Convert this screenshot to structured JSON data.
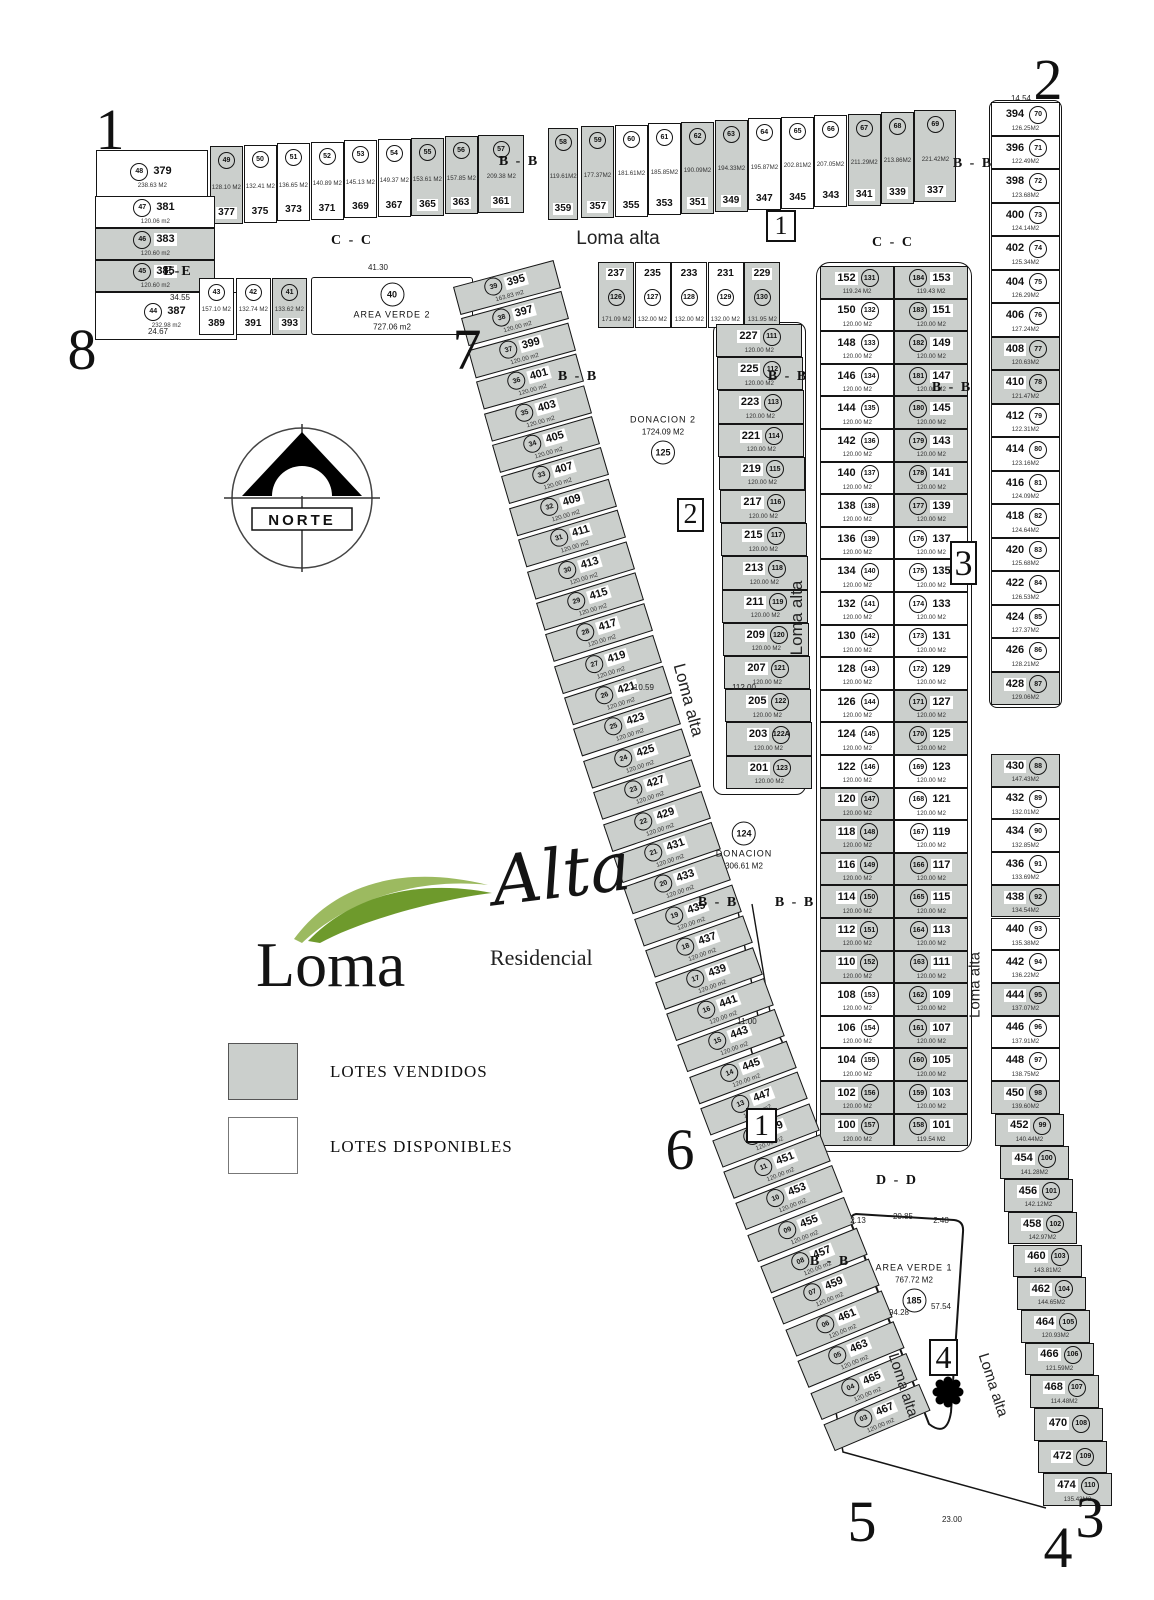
{
  "title": "Loma Alta Residencial - plano de lotificacion",
  "logo": {
    "loma": "Loma",
    "alta": "Alta",
    "residencial": "Residencial"
  },
  "legend": {
    "sold_label": "LOTES VENDIDOS",
    "available_label": "LOTES DISPONIBLES",
    "sold_color": "#cbcfcc",
    "available_color": "#ffffff"
  },
  "north": {
    "label": "NORTE"
  },
  "colors": {
    "line": "#151515",
    "sold_fill": "#cbcfcc",
    "logo_green_dark": "#6e9a2c",
    "logo_green_light": "#9cba60"
  },
  "areas": [
    {
      "name": "AREA VERDE 2",
      "area": "727.06 m2",
      "circle": "40",
      "x": 392,
      "y": 307,
      "seq": [
        "circle",
        "name",
        "area"
      ],
      "box": [
        311,
        277,
        162,
        58
      ]
    },
    {
      "name": "DONACION 2",
      "area": "1724.09 M2",
      "circle": "125",
      "x": 663,
      "y": 440,
      "seq": [
        "name",
        "area",
        "circle"
      ]
    },
    {
      "name": "DONACION",
      "area": "306.61 M2",
      "circle": "124",
      "x": 744,
      "y": 846,
      "seq": [
        "circle",
        "name",
        "area"
      ]
    },
    {
      "name": "AREA VERDE 1",
      "area": "767.72 M2",
      "circle": "185",
      "x": 914,
      "y": 1288,
      "seq": [
        "name",
        "area",
        "circle"
      ]
    }
  ],
  "street_labels": [
    {
      "t": "Loma alta",
      "x": 618,
      "y": 239,
      "r": 0,
      "fs": 19
    },
    {
      "t": "Loma alta",
      "x": 797,
      "y": 618,
      "r": -90,
      "fs": 17
    },
    {
      "t": "Loma alta",
      "x": 975,
      "y": 985,
      "r": -90,
      "fs": 15
    },
    {
      "t": "Loma alta",
      "x": 688,
      "y": 700,
      "r": 75,
      "fs": 17
    },
    {
      "t": "Loma alta",
      "x": 903,
      "y": 1385,
      "r": 72,
      "fs": 15
    },
    {
      "t": "Loma alta",
      "x": 993,
      "y": 1385,
      "r": 72,
      "fs": 15
    }
  ],
  "section_labels": [
    {
      "t": "C - C",
      "x": 352,
      "y": 241
    },
    {
      "t": "C - C",
      "x": 893,
      "y": 243
    },
    {
      "t": "B - B",
      "x": 519,
      "y": 162
    },
    {
      "t": "B - B",
      "x": 973,
      "y": 164
    },
    {
      "t": "B - B",
      "x": 578,
      "y": 377
    },
    {
      "t": "B - B",
      "x": 788,
      "y": 377
    },
    {
      "t": "B - B",
      "x": 952,
      "y": 388
    },
    {
      "t": "B - B",
      "x": 718,
      "y": 903
    },
    {
      "t": "B - B",
      "x": 795,
      "y": 903
    },
    {
      "t": "B - B",
      "x": 830,
      "y": 1262
    },
    {
      "t": "D - D",
      "x": 897,
      "y": 1181
    },
    {
      "t": "E-E",
      "x": 178,
      "y": 272
    }
  ],
  "corner_numbers": [
    {
      "t": "1",
      "x": 110,
      "y": 130
    },
    {
      "t": "2",
      "x": 1048,
      "y": 80
    },
    {
      "t": "8",
      "x": 82,
      "y": 350
    },
    {
      "t": "7",
      "x": 467,
      "y": 350
    },
    {
      "t": "6",
      "x": 680,
      "y": 1150
    },
    {
      "t": "5",
      "x": 862,
      "y": 1522
    },
    {
      "t": "3",
      "x": 1090,
      "y": 1518
    },
    {
      "t": "4",
      "x": 1058,
      "y": 1548
    }
  ],
  "boxed_numbers": [
    {
      "t": "1",
      "x": 766,
      "y": 210,
      "w": 30,
      "h": 32,
      "fs": 26
    },
    {
      "t": "2",
      "x": 677,
      "y": 498,
      "w": 27,
      "h": 34,
      "fs": 28
    },
    {
      "t": "3",
      "x": 950,
      "y": 541,
      "w": 27,
      "h": 44,
      "fs": 36
    },
    {
      "t": "1",
      "x": 746,
      "y": 1108,
      "w": 31,
      "h": 35,
      "fs": 30
    },
    {
      "t": "4",
      "x": 929,
      "y": 1339,
      "w": 29,
      "h": 37,
      "fs": 32
    }
  ],
  "dimensions": [
    {
      "t": "41.30",
      "x": 378,
      "y": 268
    },
    {
      "t": "110.59",
      "x": 642,
      "y": 688
    },
    {
      "t": "112.00",
      "x": 744,
      "y": 688
    },
    {
      "t": "11.00",
      "x": 747,
      "y": 1022
    },
    {
      "t": "23.00",
      "x": 952,
      "y": 1520
    },
    {
      "t": "2.13",
      "x": 858,
      "y": 1221
    },
    {
      "t": "20.85",
      "x": 903,
      "y": 1217
    },
    {
      "t": "2.48",
      "x": 941,
      "y": 1221
    },
    {
      "t": "57.54",
      "x": 941,
      "y": 1307
    },
    {
      "t": "94.28",
      "x": 899,
      "y": 1313
    },
    {
      "t": "14.54",
      "x": 1021,
      "y": 99
    },
    {
      "t": "24.67",
      "x": 158,
      "y": 332
    },
    {
      "t": "34.55",
      "x": 180,
      "y": 298
    }
  ],
  "lots": {
    "lot_379": [
      "379",
      "48",
      "238.63 M2",
      0
    ],
    "strip_a": [
      [
        "377",
        "49",
        "128.10 M2",
        1
      ],
      [
        "375",
        "50",
        "132.41 M2",
        0
      ],
      [
        "373",
        "51",
        "136.65 M2",
        0
      ],
      [
        "371",
        "52",
        "140.89 M2",
        0
      ],
      [
        "369",
        "53",
        "145.13 M2",
        0
      ],
      [
        "367",
        "54",
        "149.37 M2",
        0
      ],
      [
        "365",
        "55",
        "153.61 M2",
        1
      ],
      [
        "363",
        "56",
        "157.85 M2",
        1
      ],
      [
        "361",
        "57",
        "209.38 M2",
        1
      ]
    ],
    "col_b": [
      [
        "381",
        "47",
        "120.06 m2",
        0
      ],
      [
        "383",
        "46",
        "120.60 m2",
        1
      ],
      [
        "385",
        "45",
        "120.60 m2",
        1
      ],
      [
        "387",
        "44",
        "232.98 m2",
        0
      ]
    ],
    "row_c": [
      [
        "389",
        "43",
        "157.10 M2",
        0
      ],
      [
        "391",
        "42",
        "132.74 M2",
        0
      ],
      [
        "393",
        "41",
        "133.62 M2",
        1
      ]
    ],
    "strip_d": [
      [
        "359",
        "58",
        "119.61M2",
        1
      ],
      [
        "357",
        "59",
        "177.37M2",
        1
      ],
      [
        "355",
        "60",
        "181.61M2",
        0
      ],
      [
        "353",
        "61",
        "185.85M2",
        0
      ],
      [
        "351",
        "62",
        "190.09M2",
        1
      ],
      [
        "349",
        "63",
        "194.33M2",
        1
      ],
      [
        "347",
        "64",
        "195.87M2",
        0
      ],
      [
        "345",
        "65",
        "202.81M2",
        0
      ],
      [
        "343",
        "66",
        "207.05M2",
        0
      ],
      [
        "341",
        "67",
        "211.29M2",
        1
      ],
      [
        "339",
        "68",
        "213.86M2",
        1
      ],
      [
        "337",
        "69",
        "221.42M2",
        1
      ]
    ],
    "row_e": [
      [
        "237",
        "126",
        "171.09 M2",
        1
      ],
      [
        "235",
        "127",
        "132.00 M2",
        0
      ],
      [
        "233",
        "128",
        "132.00 M2",
        0
      ],
      [
        "231",
        "129",
        "132.00 M2",
        0
      ],
      [
        "229",
        "130",
        "131.95 M2",
        1
      ]
    ],
    "col_f": [
      [
        "227",
        "111",
        "120.00 M2",
        1
      ],
      [
        "225",
        "112",
        "120.00 M2",
        1
      ],
      [
        "223",
        "113",
        "120.00 M2",
        1
      ],
      [
        "221",
        "114",
        "120.00 M2",
        1
      ],
      [
        "219",
        "115",
        "120.00 M2",
        1
      ],
      [
        "217",
        "116",
        "120.00 M2",
        1
      ],
      [
        "215",
        "117",
        "120.00 M2",
        1
      ],
      [
        "213",
        "118",
        "120.00 M2",
        1
      ],
      [
        "211",
        "119",
        "120.00 M2",
        1
      ],
      [
        "209",
        "120",
        "120.00 M2",
        1
      ],
      [
        "207",
        "121",
        "120.00 M2",
        1
      ],
      [
        "205",
        "122",
        "120.00 M2",
        1
      ],
      [
        "203",
        "122A",
        "120.00 M2",
        1
      ],
      [
        "201",
        "123",
        "120.00 M2",
        1
      ]
    ],
    "col_g": [
      [
        "152",
        "131",
        "119.24 M2",
        1
      ],
      [
        "150",
        "132",
        "120.00 M2",
        0
      ],
      [
        "148",
        "133",
        "120.00 M2",
        0
      ],
      [
        "146",
        "134",
        "120.00 M2",
        0
      ],
      [
        "144",
        "135",
        "120.00 M2",
        0
      ],
      [
        "142",
        "136",
        "120.00 M2",
        0
      ],
      [
        "140",
        "137",
        "120.00 M2",
        0
      ],
      [
        "138",
        "138",
        "120.00 M2",
        0
      ],
      [
        "136",
        "139",
        "120.00 M2",
        0
      ],
      [
        "134",
        "140",
        "120.00 M2",
        0
      ],
      [
        "132",
        "141",
        "120.00 M2",
        0
      ],
      [
        "130",
        "142",
        "120.00 M2",
        0
      ],
      [
        "128",
        "143",
        "120.00 M2",
        0
      ],
      [
        "126",
        "144",
        "120.00 M2",
        0
      ],
      [
        "124",
        "145",
        "120.00 M2",
        0
      ],
      [
        "122",
        "146",
        "120.00 M2",
        0
      ],
      [
        "120",
        "147",
        "120.00 M2",
        1
      ],
      [
        "118",
        "148",
        "120.00 M2",
        1
      ],
      [
        "116",
        "149",
        "120.00 M2",
        1
      ],
      [
        "114",
        "150",
        "120.00 M2",
        1
      ],
      [
        "112",
        "151",
        "120.00 M2",
        1
      ],
      [
        "110",
        "152",
        "120.00 M2",
        1
      ],
      [
        "108",
        "153",
        "120.00 M2",
        0
      ],
      [
        "106",
        "154",
        "120.00 M2",
        0
      ],
      [
        "104",
        "155",
        "120.00 M2",
        0
      ],
      [
        "102",
        "156",
        "120.00 M2",
        1
      ],
      [
        "100",
        "157",
        "120.00 M2",
        1
      ]
    ],
    "col_h": [
      [
        "153",
        "184",
        "119.43 M2",
        1
      ],
      [
        "151",
        "183",
        "120.00 M2",
        1
      ],
      [
        "149",
        "182",
        "120.00 M2",
        1
      ],
      [
        "147",
        "181",
        "120.00 M2",
        1
      ],
      [
        "145",
        "180",
        "120.00 M2",
        1
      ],
      [
        "143",
        "179",
        "120.00 M2",
        1
      ],
      [
        "141",
        "178",
        "120.00 M2",
        1
      ],
      [
        "139",
        "177",
        "120.00 M2",
        1
      ],
      [
        "137",
        "176",
        "120.00 M2",
        0
      ],
      [
        "135",
        "175",
        "120.00 M2",
        0
      ],
      [
        "133",
        "174",
        "120.00 M2",
        0
      ],
      [
        "131",
        "173",
        "120.00 M2",
        0
      ],
      [
        "129",
        "172",
        "120.00 M2",
        0
      ],
      [
        "127",
        "171",
        "120.00 M2",
        1
      ],
      [
        "125",
        "170",
        "120.00 M2",
        1
      ],
      [
        "123",
        "169",
        "120.00 M2",
        0
      ],
      [
        "121",
        "168",
        "120.00 M2",
        0
      ],
      [
        "119",
        "167",
        "120.00 M2",
        0
      ],
      [
        "117",
        "166",
        "120.00 M2",
        1
      ],
      [
        "115",
        "165",
        "120.00 M2",
        1
      ],
      [
        "113",
        "164",
        "120.00 M2",
        1
      ],
      [
        "111",
        "163",
        "120.00 M2",
        1
      ],
      [
        "109",
        "162",
        "120.00 M2",
        1
      ],
      [
        "107",
        "161",
        "120.00 M2",
        1
      ],
      [
        "105",
        "160",
        "120.00 M2",
        1
      ],
      [
        "103",
        "159",
        "120.00 M2",
        1
      ],
      [
        "101",
        "158",
        "119.54 M2",
        1
      ]
    ],
    "col_i": [
      [
        "394",
        "70",
        "126.25M2",
        0
      ],
      [
        "396",
        "71",
        "122.49M2",
        0
      ],
      [
        "398",
        "72",
        "123.68M2",
        0
      ],
      [
        "400",
        "73",
        "124.14M2",
        0
      ],
      [
        "402",
        "74",
        "125.34M2",
        0
      ],
      [
        "404",
        "75",
        "126.29M2",
        0
      ],
      [
        "406",
        "76",
        "127.24M2",
        0
      ],
      [
        "408",
        "77",
        "120.63M2",
        1
      ],
      [
        "410",
        "78",
        "121.47M2",
        1
      ],
      [
        "412",
        "79",
        "122.31M2",
        0
      ],
      [
        "414",
        "80",
        "123.16M2",
        0
      ],
      [
        "416",
        "81",
        "124.09M2",
        0
      ],
      [
        "418",
        "82",
        "124.64M2",
        0
      ],
      [
        "420",
        "83",
        "125.68M2",
        0
      ],
      [
        "422",
        "84",
        "126.53M2",
        0
      ],
      [
        "424",
        "85",
        "127.37M2",
        0
      ],
      [
        "426",
        "86",
        "128.21M2",
        0
      ],
      [
        "428",
        "87",
        "129.06M2",
        1
      ]
    ],
    "col_j": [
      [
        "430",
        "88",
        "147.43M2",
        1
      ],
      [
        "432",
        "89",
        "132.01M2",
        0
      ],
      [
        "434",
        "90",
        "132.85M2",
        0
      ],
      [
        "436",
        "91",
        "133.69M2",
        0
      ],
      [
        "438",
        "92",
        "134.54M2",
        1
      ],
      [
        "440",
        "93",
        "135.38M2",
        0
      ],
      [
        "442",
        "94",
        "136.22M2",
        0
      ],
      [
        "444",
        "95",
        "137.07M2",
        1
      ],
      [
        "446",
        "96",
        "137.91M2",
        0
      ],
      [
        "448",
        "97",
        "138.75M2",
        0
      ],
      [
        "450",
        "98",
        "139.60M2",
        1
      ],
      [
        "452",
        "99",
        "140.44M2",
        1
      ],
      [
        "454",
        "100",
        "141.28M2",
        1
      ],
      [
        "456",
        "101",
        "142.12M2",
        1
      ],
      [
        "458",
        "102",
        "142.97M2",
        1
      ],
      [
        "460",
        "103",
        "143.81M2",
        1
      ],
      [
        "462",
        "104",
        "144.65M2",
        1
      ],
      [
        "464",
        "105",
        "120.93M2",
        1
      ],
      [
        "466",
        "106",
        "121.59M2",
        1
      ],
      [
        "468",
        "107",
        "114.48M2",
        1
      ],
      [
        "470",
        "108",
        "",
        1
      ],
      [
        "472",
        "109",
        "",
        1
      ],
      [
        "474",
        "110",
        "135.43M2",
        1
      ]
    ],
    "diag_k": [
      [
        "395",
        "39",
        "163.83 m2",
        1
      ],
      [
        "397",
        "38",
        "120.00 m2",
        1
      ],
      [
        "399",
        "37",
        "120.00 m2",
        1
      ],
      [
        "401",
        "36",
        "120.00 m2",
        1
      ],
      [
        "403",
        "35",
        "120.00 m2",
        1
      ],
      [
        "405",
        "34",
        "120.00 m2",
        1
      ],
      [
        "407",
        "33",
        "120.00 m2",
        1
      ],
      [
        "409",
        "32",
        "120.00 m2",
        1
      ],
      [
        "411",
        "31",
        "120.00 m2",
        1
      ],
      [
        "413",
        "30",
        "120.00 m2",
        1
      ],
      [
        "415",
        "29",
        "120.00 m2",
        1
      ],
      [
        "417",
        "28",
        "120.00 m2",
        1
      ],
      [
        "419",
        "27",
        "120.00 m2",
        1
      ],
      [
        "421",
        "26",
        "120.00 m2",
        1
      ],
      [
        "423",
        "25",
        "120.00 m2",
        1
      ],
      [
        "425",
        "24",
        "120.00 m2",
        1
      ],
      [
        "427",
        "23",
        "120.00 m2",
        1
      ],
      [
        "429",
        "22",
        "120.00 m2",
        1
      ],
      [
        "431",
        "21",
        "120.00 m2",
        1
      ],
      [
        "433",
        "20",
        "120.00 m2",
        1
      ],
      [
        "435",
        "19",
        "120.00 m2",
        1
      ],
      [
        "437",
        "18",
        "120.00 m2",
        1
      ],
      [
        "439",
        "17",
        "120.00 m2",
        1
      ],
      [
        "441",
        "16",
        "120.00 m2",
        1
      ],
      [
        "443",
        "15",
        "120.00 m2",
        1
      ],
      [
        "445",
        "14",
        "120.00 m2",
        1
      ],
      [
        "447",
        "13",
        "120.00 m2",
        1
      ],
      [
        "449",
        "12",
        "120.00 m2",
        1
      ],
      [
        "451",
        "11",
        "120.00 m2",
        1
      ],
      [
        "453",
        "10",
        "120.00 m2",
        1
      ],
      [
        "455",
        "09",
        "120.00 m2",
        1
      ],
      [
        "457",
        "08",
        "120.00 m2",
        1
      ],
      [
        "459",
        "07",
        "120.00 m2",
        1
      ],
      [
        "461",
        "06",
        "120.00 m2",
        1
      ],
      [
        "463",
        "05",
        "120.00 m2",
        1
      ],
      [
        "465",
        "04",
        "120.00 m2",
        1
      ],
      [
        "467",
        "03",
        "120.00 m2",
        1
      ]
    ]
  }
}
